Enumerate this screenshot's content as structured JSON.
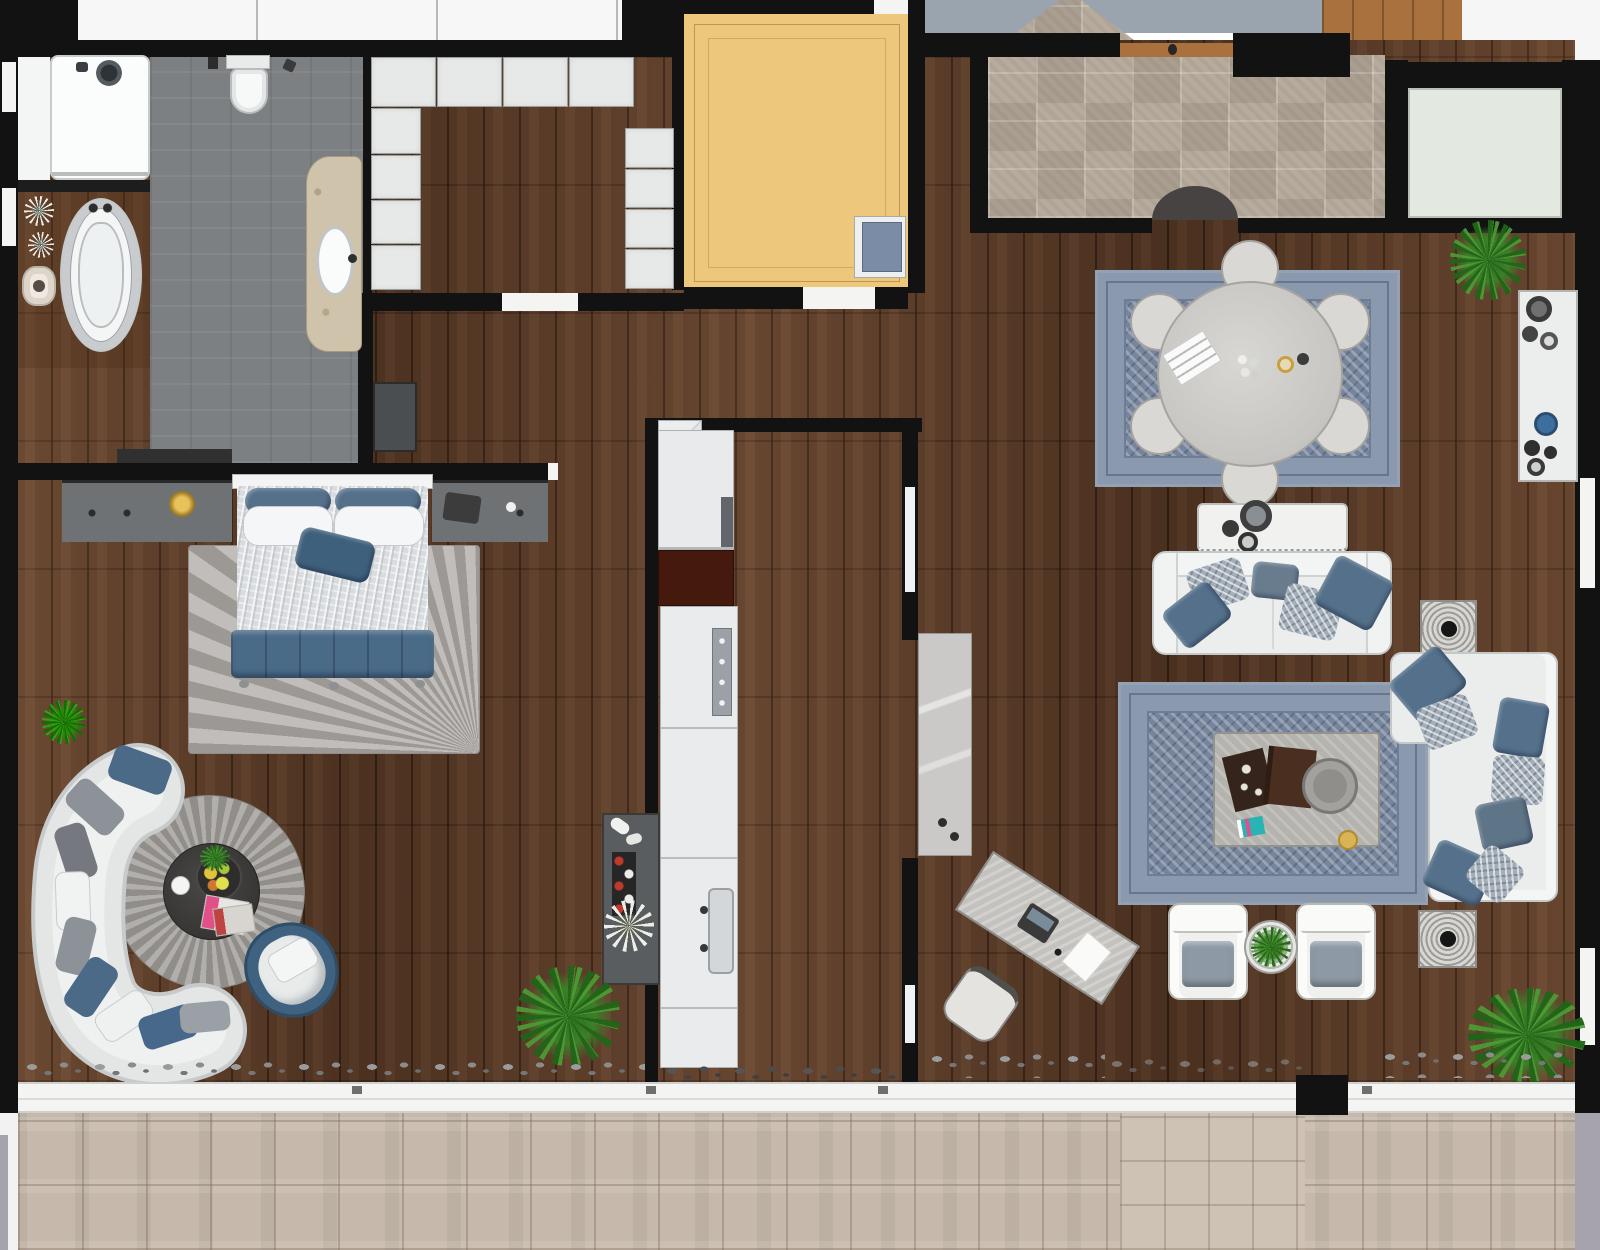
{
  "meta": {
    "title": "Apartment floor plan — photorealistic top-down render",
    "view": "top-down 2D rendered floor plan",
    "visible_text": "none"
  },
  "palette": {
    "wall": "#121212",
    "wood_floor": "#5a3a26",
    "bath_gray_floor": "#7d8083",
    "foyer_tile": "#b2a698",
    "balcony_tile": "#c6b9ac",
    "storage_room_yellow": "#edc77b",
    "rug_blue": "#76849c",
    "round_rug_gray": "#9b9894",
    "sofa_white": "#e6e8e8",
    "accent_pillow_blue": "#4a6a87",
    "bed_bench_blue": "#4a6b88",
    "plant_green": "#3d7f28",
    "outside_corridor_gray": "#9aa4ae",
    "door_panel_gray": "#cac9c8"
  },
  "rooms": [
    {
      "id": "bathroom",
      "label": "Bathroom",
      "furniture": [
        "shower",
        "bathtub",
        "toilet",
        "vanity with sink",
        "stool",
        "bench"
      ]
    },
    {
      "id": "walk-in-closet",
      "label": "Walk-in closet",
      "furniture": [
        "wardrobe cabinets top row",
        "wardrobe cabinets left",
        "wardrobe cabinets right",
        "dresser"
      ]
    },
    {
      "id": "bedroom",
      "label": "Bedroom",
      "furniture": [
        "double bed with blue bench",
        "nightstand consoles",
        "area rug",
        "curved sectional sofa",
        "round rug",
        "round coffee table",
        "blue tub chair",
        "bar cabinet with wine rack",
        "plants"
      ]
    },
    {
      "id": "storage-room",
      "label": "Storage / elevator room",
      "furniture": [
        "duct box"
      ]
    },
    {
      "id": "hallway",
      "label": "Hallway",
      "furniture": []
    },
    {
      "id": "kitchen",
      "label": "Kitchen corridor",
      "furniture": [
        "counter run",
        "stove section",
        "oven",
        "sink",
        "corner shelf"
      ]
    },
    {
      "id": "entry-foyer",
      "label": "Entry foyer",
      "furniture": [
        "half-round door mat",
        "plant"
      ]
    },
    {
      "id": "living-dining-room",
      "label": "Living / dining room",
      "furniture": [
        "round dining table with six chairs",
        "blue dining rug",
        "media console",
        "two-seat sofa",
        "side tables",
        "blue living rug",
        "large coffee table",
        "L-shaped sofa",
        "two armchairs",
        "round plant table",
        "desk with chair",
        "wall console",
        "sliding door panel",
        "plants"
      ]
    },
    {
      "id": "utility-room",
      "label": "Utility ledge room",
      "furniture": []
    },
    {
      "id": "balcony",
      "label": "Balcony terrace",
      "furniture": [
        "sliding glass doors",
        "tile paving",
        "pebble borders"
      ]
    }
  ]
}
